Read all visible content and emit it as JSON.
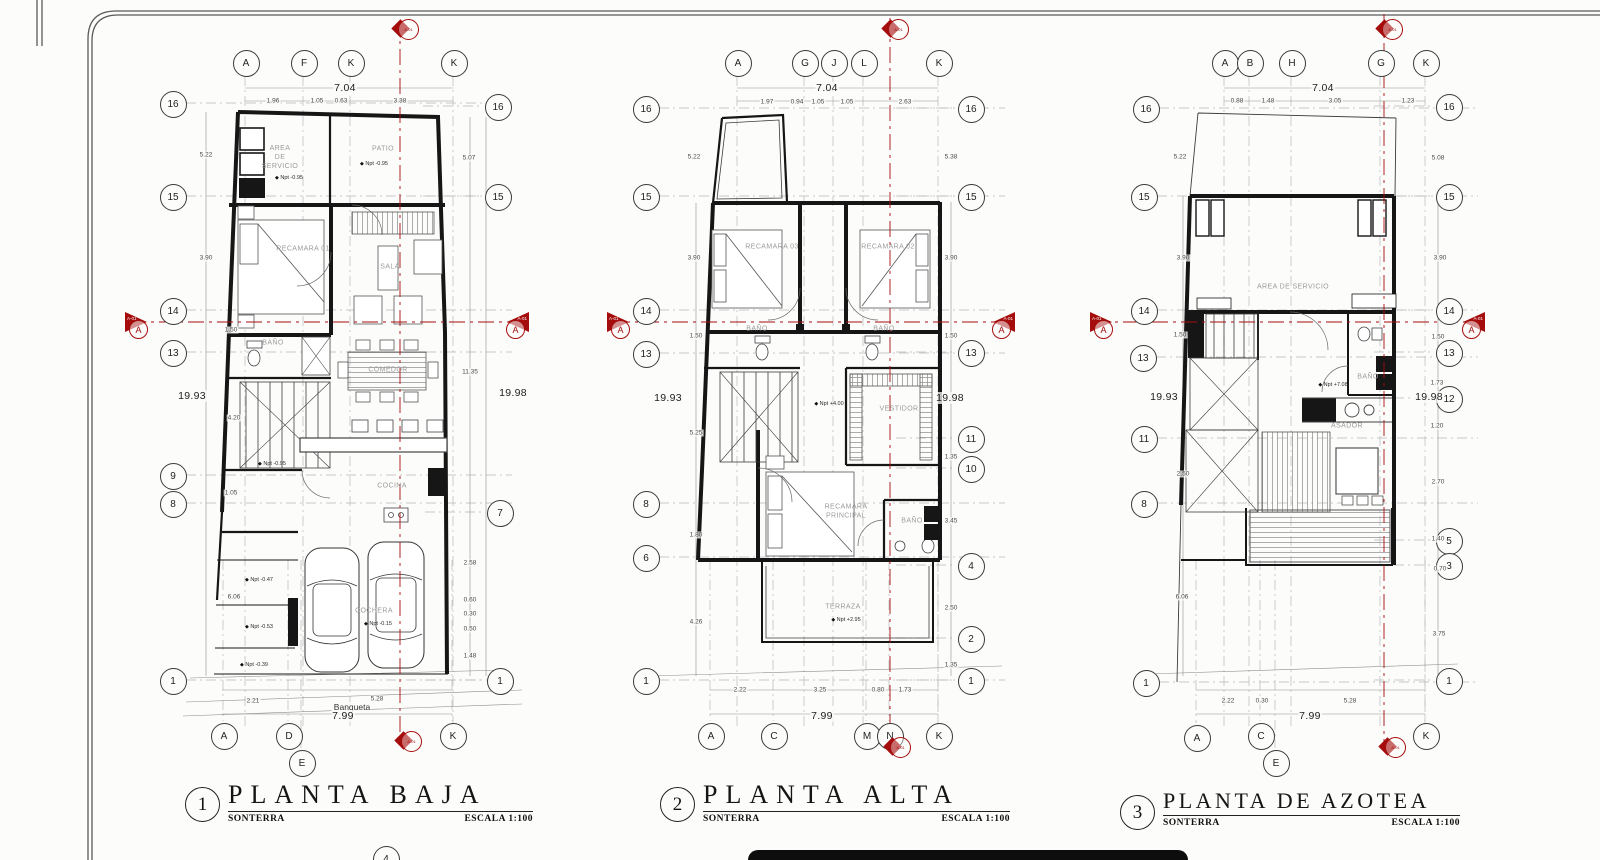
{
  "accent_color": "#a50d0d",
  "plans": [
    {
      "number": "1",
      "title": "PLANTA BAJA",
      "subtitle": "SONTERRA",
      "scale": "ESCALA 1:100",
      "bubbles": [
        {
          "label": "A",
          "x": 245,
          "y": 62,
          "side": "top"
        },
        {
          "label": "F",
          "x": 303,
          "y": 62,
          "side": "top"
        },
        {
          "label": "K",
          "x": 350,
          "y": 62,
          "side": "top"
        },
        {
          "label": "K",
          "x": 453,
          "y": 62,
          "side": "top"
        },
        {
          "label": "16",
          "x": 172,
          "y": 103,
          "side": "left"
        },
        {
          "label": "15",
          "x": 172,
          "y": 196,
          "side": "left"
        },
        {
          "label": "14",
          "x": 172,
          "y": 310,
          "side": "left"
        },
        {
          "label": "13",
          "x": 172,
          "y": 352,
          "side": "left"
        },
        {
          "label": "9",
          "x": 172,
          "y": 475,
          "side": "left"
        },
        {
          "label": "8",
          "x": 172,
          "y": 503,
          "side": "left"
        },
        {
          "label": "1",
          "x": 172,
          "y": 680,
          "side": "left"
        },
        {
          "label": "16",
          "x": 497,
          "y": 106,
          "side": "right"
        },
        {
          "label": "15",
          "x": 497,
          "y": 196,
          "side": "right"
        },
        {
          "label": "7",
          "x": 499,
          "y": 512,
          "side": "right"
        },
        {
          "label": "1",
          "x": 499,
          "y": 680,
          "side": "right"
        },
        {
          "label": "A",
          "x": 223,
          "y": 735,
          "side": "bottom"
        },
        {
          "label": "D",
          "x": 288,
          "y": 735,
          "side": "bottom"
        },
        {
          "label": "E",
          "x": 301,
          "y": 762,
          "side": "bottom"
        },
        {
          "label": "K",
          "x": 452,
          "y": 735,
          "side": "bottom"
        },
        {
          "label": "4",
          "x": 385,
          "y": 858,
          "side": "bottom"
        }
      ],
      "dims": [
        {
          "text": "7.04",
          "x": 345,
          "y": 88,
          "style": "big"
        },
        {
          "text": "1.96",
          "x": 273,
          "y": 101
        },
        {
          "text": "1.05",
          "x": 317,
          "y": 101
        },
        {
          "text": "0.63",
          "x": 341,
          "y": 101
        },
        {
          "text": "3.38",
          "x": 400,
          "y": 101
        },
        {
          "text": "19.93",
          "x": 192,
          "y": 396,
          "style": "big"
        },
        {
          "text": "5.22",
          "x": 206,
          "y": 155
        },
        {
          "text": "3.90",
          "x": 206,
          "y": 258
        },
        {
          "text": "1.50",
          "x": 231,
          "y": 330
        },
        {
          "text": "4.20",
          "x": 234,
          "y": 418
        },
        {
          "text": "1.05",
          "x": 231,
          "y": 493
        },
        {
          "text": "6.06",
          "x": 234,
          "y": 597
        },
        {
          "text": "19.98",
          "x": 513,
          "y": 393,
          "style": "big"
        },
        {
          "text": "5.07",
          "x": 469,
          "y": 158
        },
        {
          "text": "11.35",
          "x": 470,
          "y": 372
        },
        {
          "text": "2.58",
          "x": 470,
          "y": 563
        },
        {
          "text": "0.60",
          "x": 470,
          "y": 600
        },
        {
          "text": "0.30",
          "x": 470,
          "y": 614
        },
        {
          "text": "0.50",
          "x": 470,
          "y": 629
        },
        {
          "text": "1.48",
          "x": 470,
          "y": 656
        },
        {
          "text": "2.21",
          "x": 253,
          "y": 701
        },
        {
          "text": "5.28",
          "x": 377,
          "y": 699
        },
        {
          "text": "Banqueta",
          "x": 352,
          "y": 707,
          "style": "word"
        },
        {
          "text": "7.99",
          "x": 343,
          "y": 716,
          "style": "big"
        }
      ],
      "rooms": [
        {
          "text": "AREA\nDE\nSERVICIO",
          "x": 280,
          "y": 158
        },
        {
          "text": "PATIO",
          "x": 383,
          "y": 150
        },
        {
          "text": "RECAMARA 01",
          "x": 303,
          "y": 250
        },
        {
          "text": "SALA",
          "x": 390,
          "y": 268
        },
        {
          "text": "BAÑO",
          "x": 273,
          "y": 344
        },
        {
          "text": "COMEDOR",
          "x": 388,
          "y": 371
        },
        {
          "text": "COCINA",
          "x": 392,
          "y": 487
        },
        {
          "text": "COCHERA",
          "x": 374,
          "y": 612
        }
      ],
      "elevations": [
        {
          "text": "Npt -0.95",
          "x": 289,
          "y": 178
        },
        {
          "text": "Npt -0.95",
          "x": 374,
          "y": 164
        },
        {
          "text": "Npt -0.95",
          "x": 272,
          "y": 464
        },
        {
          "text": "Npt -0.47",
          "x": 259,
          "y": 580
        },
        {
          "text": "Npt -0.53",
          "x": 259,
          "y": 627
        },
        {
          "text": "Npt -0.39",
          "x": 254,
          "y": 665
        },
        {
          "text": "Npt -0.15",
          "x": 378,
          "y": 624
        }
      ],
      "markers": [
        {
          "dir": "up",
          "x": 400,
          "y": 28,
          "code": "A-01"
        },
        {
          "dir": "down",
          "x": 403,
          "y": 740,
          "code": "A-01"
        },
        {
          "dir": "left",
          "x": 141,
          "y": 322,
          "code": "A-01",
          "letter": "A"
        },
        {
          "dir": "right",
          "x": 513,
          "y": 322,
          "code": "A-01",
          "letter": "A"
        }
      ]
    },
    {
      "number": "2",
      "title": "PLANTA ALTA",
      "subtitle": "SONTERRA",
      "scale": "ESCALA 1:100",
      "bubbles": [
        {
          "label": "A",
          "x": 737,
          "y": 62,
          "side": "top"
        },
        {
          "label": "G",
          "x": 804,
          "y": 62,
          "side": "top"
        },
        {
          "label": "J",
          "x": 833,
          "y": 62,
          "side": "top"
        },
        {
          "label": "L",
          "x": 863,
          "y": 62,
          "side": "top"
        },
        {
          "label": "K",
          "x": 938,
          "y": 62,
          "side": "top"
        },
        {
          "label": "16",
          "x": 645,
          "y": 108,
          "side": "left"
        },
        {
          "label": "15",
          "x": 645,
          "y": 196,
          "side": "left"
        },
        {
          "label": "14",
          "x": 645,
          "y": 310,
          "side": "left"
        },
        {
          "label": "13",
          "x": 645,
          "y": 353,
          "side": "left"
        },
        {
          "label": "8",
          "x": 645,
          "y": 503,
          "side": "left"
        },
        {
          "label": "6",
          "x": 645,
          "y": 557,
          "side": "left"
        },
        {
          "label": "1",
          "x": 645,
          "y": 680,
          "side": "left"
        },
        {
          "label": "16",
          "x": 970,
          "y": 108,
          "side": "right"
        },
        {
          "label": "15",
          "x": 970,
          "y": 196,
          "side": "right"
        },
        {
          "label": "13",
          "x": 970,
          "y": 352,
          "side": "right"
        },
        {
          "label": "11",
          "x": 970,
          "y": 438,
          "side": "right"
        },
        {
          "label": "10",
          "x": 970,
          "y": 468,
          "side": "right"
        },
        {
          "label": "4",
          "x": 970,
          "y": 565,
          "side": "right"
        },
        {
          "label": "2",
          "x": 970,
          "y": 638,
          "side": "right"
        },
        {
          "label": "1",
          "x": 970,
          "y": 680,
          "side": "right"
        },
        {
          "label": "A",
          "x": 710,
          "y": 735,
          "side": "bottom"
        },
        {
          "label": "C",
          "x": 773,
          "y": 735,
          "side": "bottom"
        },
        {
          "label": "M",
          "x": 866,
          "y": 735,
          "side": "bottom"
        },
        {
          "label": "N",
          "x": 889,
          "y": 735,
          "side": "bottom"
        },
        {
          "label": "K",
          "x": 938,
          "y": 735,
          "side": "bottom"
        }
      ],
      "dims": [
        {
          "text": "7.04",
          "x": 827,
          "y": 88,
          "style": "big"
        },
        {
          "text": "1.97",
          "x": 767,
          "y": 102
        },
        {
          "text": "0.94",
          "x": 797,
          "y": 102
        },
        {
          "text": "1.05",
          "x": 818,
          "y": 102
        },
        {
          "text": "1.05",
          "x": 847,
          "y": 102
        },
        {
          "text": "2.63",
          "x": 905,
          "y": 102
        },
        {
          "text": "19.93",
          "x": 668,
          "y": 398,
          "style": "big"
        },
        {
          "text": "5.22",
          "x": 694,
          "y": 157
        },
        {
          "text": "3.90",
          "x": 694,
          "y": 258
        },
        {
          "text": "1.50",
          "x": 696,
          "y": 336
        },
        {
          "text": "5.25",
          "x": 696,
          "y": 433
        },
        {
          "text": "1.80",
          "x": 696,
          "y": 535
        },
        {
          "text": "4.26",
          "x": 696,
          "y": 622
        },
        {
          "text": "19.98",
          "x": 950,
          "y": 398,
          "style": "big"
        },
        {
          "text": "5.38",
          "x": 951,
          "y": 157
        },
        {
          "text": "3.90",
          "x": 951,
          "y": 258
        },
        {
          "text": "1.50",
          "x": 951,
          "y": 336
        },
        {
          "text": "1.35",
          "x": 951,
          "y": 457
        },
        {
          "text": "3.45",
          "x": 951,
          "y": 521
        },
        {
          "text": "2.50",
          "x": 951,
          "y": 608
        },
        {
          "text": "1.35",
          "x": 951,
          "y": 665
        },
        {
          "text": "2.22",
          "x": 740,
          "y": 690
        },
        {
          "text": "3.25",
          "x": 820,
          "y": 690
        },
        {
          "text": "0.80",
          "x": 878,
          "y": 690
        },
        {
          "text": "1.73",
          "x": 905,
          "y": 690
        },
        {
          "text": "7.99",
          "x": 822,
          "y": 716,
          "style": "big"
        }
      ],
      "rooms": [
        {
          "text": "RECAMARA 03",
          "x": 772,
          "y": 248
        },
        {
          "text": "RECAMARA 02",
          "x": 888,
          "y": 248
        },
        {
          "text": "BAÑO",
          "x": 757,
          "y": 330
        },
        {
          "text": "BAÑO",
          "x": 884,
          "y": 330
        },
        {
          "text": "VESTIDOR",
          "x": 899,
          "y": 410
        },
        {
          "text": "RECAMARA\nPRINCIPAL",
          "x": 846,
          "y": 512
        },
        {
          "text": "BAÑO",
          "x": 912,
          "y": 522
        },
        {
          "text": "TERRAZA",
          "x": 843,
          "y": 608
        }
      ],
      "elevations": [
        {
          "text": "Npt +4.00",
          "x": 829,
          "y": 404
        },
        {
          "text": "Npt +2.95",
          "x": 846,
          "y": 620
        }
      ],
      "markers": [
        {
          "dir": "up",
          "x": 890,
          "y": 28,
          "code": "A-01"
        },
        {
          "dir": "down",
          "x": 892,
          "y": 746,
          "code": "A-01"
        },
        {
          "dir": "left",
          "x": 623,
          "y": 322,
          "code": "A-01",
          "letter": "A"
        },
        {
          "dir": "right",
          "x": 999,
          "y": 322,
          "code": "A-01",
          "letter": "A"
        }
      ]
    },
    {
      "number": "3",
      "title": "PLANTA DE AZOTEA",
      "subtitle": "SONTERRA",
      "scale": "ESCALA 1:100",
      "bubbles": [
        {
          "label": "A",
          "x": 1224,
          "y": 62,
          "side": "top"
        },
        {
          "label": "B",
          "x": 1249,
          "y": 62,
          "side": "top"
        },
        {
          "label": "H",
          "x": 1291,
          "y": 62,
          "side": "top"
        },
        {
          "label": "G",
          "x": 1380,
          "y": 62,
          "side": "top"
        },
        {
          "label": "K",
          "x": 1425,
          "y": 62,
          "side": "top"
        },
        {
          "label": "16",
          "x": 1145,
          "y": 108,
          "side": "left"
        },
        {
          "label": "15",
          "x": 1143,
          "y": 196,
          "side": "left"
        },
        {
          "label": "14",
          "x": 1143,
          "y": 310,
          "side": "left"
        },
        {
          "label": "13",
          "x": 1142,
          "y": 357,
          "side": "left"
        },
        {
          "label": "11",
          "x": 1143,
          "y": 438,
          "side": "left"
        },
        {
          "label": "8",
          "x": 1143,
          "y": 503,
          "side": "left"
        },
        {
          "label": "1",
          "x": 1145,
          "y": 682,
          "side": "left"
        },
        {
          "label": "16",
          "x": 1448,
          "y": 106,
          "side": "right"
        },
        {
          "label": "15",
          "x": 1448,
          "y": 196,
          "side": "right"
        },
        {
          "label": "14",
          "x": 1448,
          "y": 310,
          "side": "right"
        },
        {
          "label": "13",
          "x": 1448,
          "y": 352,
          "side": "right"
        },
        {
          "label": "12",
          "x": 1448,
          "y": 398,
          "side": "right"
        },
        {
          "label": "5",
          "x": 1448,
          "y": 540,
          "side": "right"
        },
        {
          "label": "3",
          "x": 1448,
          "y": 565,
          "side": "right"
        },
        {
          "label": "1",
          "x": 1448,
          "y": 680,
          "side": "right"
        },
        {
          "label": "A",
          "x": 1196,
          "y": 737,
          "side": "bottom"
        },
        {
          "label": "C",
          "x": 1260,
          "y": 735,
          "side": "bottom"
        },
        {
          "label": "E",
          "x": 1275,
          "y": 762,
          "side": "bottom"
        },
        {
          "label": "K",
          "x": 1425,
          "y": 735,
          "side": "bottom"
        }
      ],
      "dims": [
        {
          "text": "7.04",
          "x": 1323,
          "y": 88,
          "style": "big"
        },
        {
          "text": "0.88",
          "x": 1237,
          "y": 101
        },
        {
          "text": "1.48",
          "x": 1268,
          "y": 101
        },
        {
          "text": "3.05",
          "x": 1335,
          "y": 101
        },
        {
          "text": "1.23",
          "x": 1408,
          "y": 101
        },
        {
          "text": "19.93",
          "x": 1164,
          "y": 397,
          "style": "big"
        },
        {
          "text": "5.22",
          "x": 1180,
          "y": 157
        },
        {
          "text": "3.90",
          "x": 1183,
          "y": 258
        },
        {
          "text": "1.50",
          "x": 1180,
          "y": 335
        },
        {
          "text": "2.50",
          "x": 1183,
          "y": 474
        },
        {
          "text": "6.06",
          "x": 1182,
          "y": 597
        },
        {
          "text": "19.98",
          "x": 1429,
          "y": 397,
          "style": "big"
        },
        {
          "text": "5.08",
          "x": 1438,
          "y": 158
        },
        {
          "text": "3.90",
          "x": 1440,
          "y": 258
        },
        {
          "text": "1.50",
          "x": 1438,
          "y": 337
        },
        {
          "text": "1.73",
          "x": 1437,
          "y": 383
        },
        {
          "text": "1.20",
          "x": 1437,
          "y": 426
        },
        {
          "text": "2.70",
          "x": 1438,
          "y": 482
        },
        {
          "text": "1.40",
          "x": 1438,
          "y": 539
        },
        {
          "text": "0.70",
          "x": 1440,
          "y": 569
        },
        {
          "text": "3.75",
          "x": 1439,
          "y": 634
        },
        {
          "text": "2.22",
          "x": 1228,
          "y": 701
        },
        {
          "text": "0.30",
          "x": 1262,
          "y": 701
        },
        {
          "text": "5.28",
          "x": 1350,
          "y": 701
        },
        {
          "text": "7.99",
          "x": 1310,
          "y": 716,
          "style": "big"
        }
      ],
      "rooms": [
        {
          "text": "AREA DE SERVICIO",
          "x": 1293,
          "y": 288
        },
        {
          "text": "BAÑO",
          "x": 1368,
          "y": 378
        },
        {
          "text": "ASADOR",
          "x": 1347,
          "y": 427
        }
      ],
      "elevations": [
        {
          "text": "Npt +7.08",
          "x": 1333,
          "y": 385
        }
      ],
      "markers": [
        {
          "dir": "up",
          "x": 1384,
          "y": 28,
          "code": "A-01"
        },
        {
          "dir": "down",
          "x": 1387,
          "y": 746,
          "code": "A-01"
        },
        {
          "dir": "left",
          "x": 1106,
          "y": 322,
          "code": "A-01",
          "letter": "A"
        },
        {
          "dir": "right",
          "x": 1469,
          "y": 322,
          "code": "A-01",
          "letter": "A"
        }
      ]
    }
  ]
}
